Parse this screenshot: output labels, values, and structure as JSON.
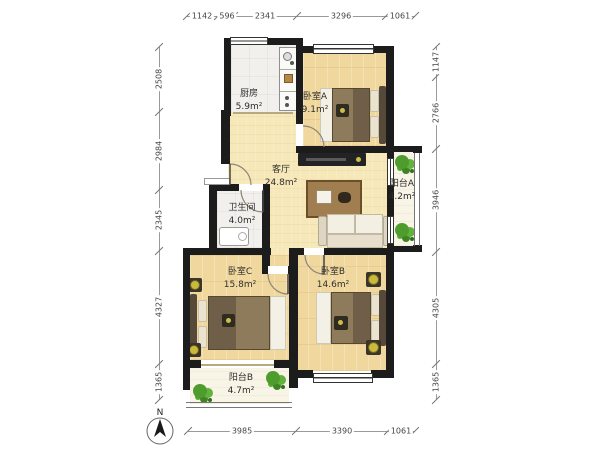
{
  "plan": {
    "compass_label": "N",
    "rooms": {
      "kitchen": {
        "name": "厨房",
        "area": "5.9m²"
      },
      "bedroom_a": {
        "name": "卧室A",
        "area": "9.1m²"
      },
      "living": {
        "name": "客厅",
        "area": "24.8m²"
      },
      "balcony_a": {
        "name": "阳台A",
        "area": "4.2m²"
      },
      "bathroom": {
        "name": "卫生间",
        "area": "4.0m²"
      },
      "bedroom_c": {
        "name": "卧室C",
        "area": "15.8m²"
      },
      "bedroom_b": {
        "name": "卧室B",
        "area": "14.6m²"
      },
      "balcony_b": {
        "name": "阳台B",
        "area": "4.7m²"
      }
    },
    "dimensions_mm": {
      "top": [
        "1142",
        "596",
        "2341",
        "3296",
        "1061"
      ],
      "bottom": [
        "3985",
        "3390",
        "1061"
      ],
      "left": [
        "2508",
        "2984",
        "2345",
        "4327",
        "1365"
      ],
      "right": [
        "1147",
        "2766",
        "3946",
        "4305",
        "1365"
      ]
    },
    "colors": {
      "wall": "#1c1c1c",
      "wood_floor": "#f0d79e",
      "living_floor": "#f6e8b8",
      "tile_floor": "#f1f0ec",
      "balcony_floor": "#f8f4e6",
      "plant_green": "#4f9c2e",
      "dimension_text": "#444444"
    }
  }
}
